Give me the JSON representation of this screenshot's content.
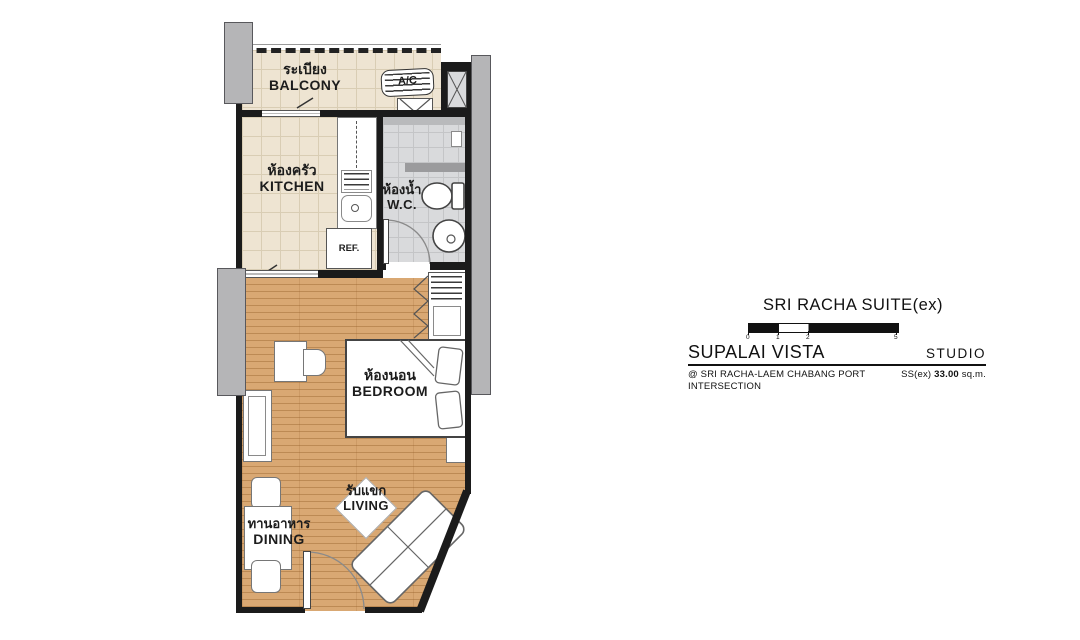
{
  "info_panel": {
    "suite_title": "SRI RACHA SUITE(ex)",
    "scale_ticks": [
      "0",
      "1",
      "2",
      "5"
    ],
    "project_name": "SUPALAI VISTA",
    "unit_type": "STUDIO",
    "location_line1": "@ SRI RACHA-LAEM CHABANG PORT",
    "location_line2": "INTERSECTION",
    "area_label": "SS(ex)",
    "area_value": "33.00",
    "area_unit": "sq.m."
  },
  "floor_plan": {
    "rooms": {
      "balcony": {
        "thai": "ระเบียง",
        "english": "BALCONY"
      },
      "kitchen": {
        "thai": "ห้องครัว",
        "english": "KITCHEN"
      },
      "wc": {
        "thai": "ห้องน้ำ",
        "english": "W.C."
      },
      "bedroom": {
        "thai": "ห้องนอน",
        "english": "BEDROOM"
      },
      "living": {
        "thai": "รับแขก",
        "english": "LIVING"
      },
      "dining": {
        "thai": "ทานอาหาร",
        "english": "DINING"
      }
    },
    "appliances": {
      "air_conditioner": "A/C",
      "refrigerator": "REF."
    }
  },
  "colors": {
    "wall": "#1b1b1b",
    "tile_beige": "#eee4d2",
    "tile_gray": "#d9dadc",
    "wood_floor": "#d9a873",
    "column_gray": "#b5b5b7",
    "text": "#111111"
  }
}
